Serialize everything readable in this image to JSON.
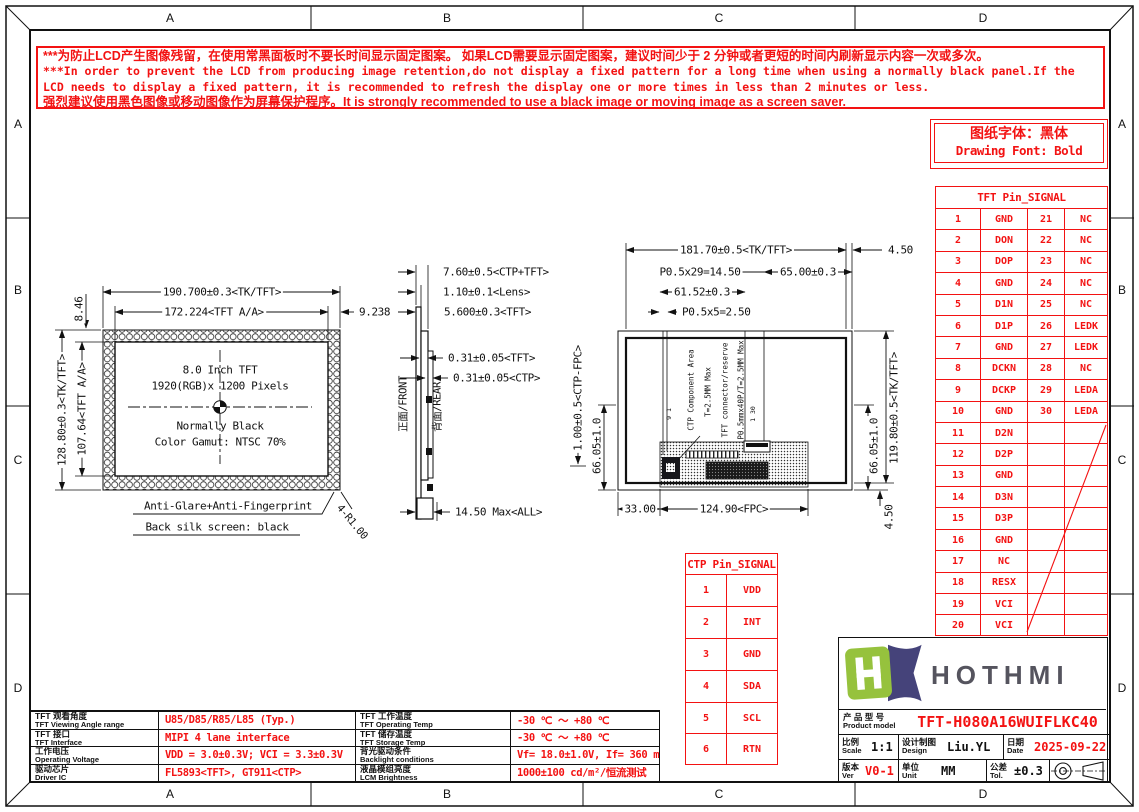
{
  "colors": {
    "red": "#f31212",
    "line_black": "#111111",
    "logo_green": "#96c23d",
    "logo_navy": "#45437a",
    "brand_gray": "#55545e"
  },
  "frame": {
    "zones": [
      "A",
      "B",
      "C",
      "D"
    ]
  },
  "warning": {
    "lines": [
      "***为防止LCD产生图像残留，在使用常黑面板时不要长时间显示固定图案。 如果LCD需要显示固定图案，建议时间少于 2 分钟或者更短的时间内刷新显示内容一次或多次。",
      "***In order to prevent the LCD from producing image retention,do not display a fixed pattern for a long time when using a normally black panel.If the",
      " LCD needs to display a fixed pattern, it is recommended to refresh the display one or more times in less than 2 minutes or less.",
      "强烈建议使用黑色图像或移动图像作为屏幕保护程序。It is strongly recommended to use a black image or moving image as a screen saver."
    ]
  },
  "font_note": {
    "cn": "图纸字体：黑体",
    "en": "Drawing Font: Bold"
  },
  "tft_pin_table": {
    "title": "TFT Pin_SIGNAL",
    "rows": [
      [
        "1",
        "GND",
        "21",
        "NC"
      ],
      [
        "2",
        "DON",
        "22",
        "NC"
      ],
      [
        "3",
        "DOP",
        "23",
        "NC"
      ],
      [
        "4",
        "GND",
        "24",
        "NC"
      ],
      [
        "5",
        "D1N",
        "25",
        "NC"
      ],
      [
        "6",
        "D1P",
        "26",
        "LEDK"
      ],
      [
        "7",
        "GND",
        "27",
        "LEDK"
      ],
      [
        "8",
        "DCKN",
        "28",
        "NC"
      ],
      [
        "9",
        "DCKP",
        "29",
        "LEDA"
      ],
      [
        "10",
        "GND",
        "30",
        "LEDA"
      ],
      [
        "11",
        "D2N",
        "",
        ""
      ],
      [
        "12",
        "D2P",
        "",
        ""
      ],
      [
        "13",
        "GND",
        "",
        ""
      ],
      [
        "14",
        "D3N",
        "",
        ""
      ],
      [
        "15",
        "D3P",
        "",
        ""
      ],
      [
        "16",
        "GND",
        "",
        ""
      ],
      [
        "17",
        "NC",
        "",
        ""
      ],
      [
        "18",
        "RESX",
        "",
        ""
      ],
      [
        "19",
        "VCI",
        "",
        ""
      ],
      [
        "20",
        "VCI",
        "",
        ""
      ]
    ]
  },
  "ctp_pin_table": {
    "title": "CTP Pin_SIGNAL",
    "rows": [
      [
        "1",
        "VDD"
      ],
      [
        "2",
        "INT"
      ],
      [
        "3",
        "GND"
      ],
      [
        "4",
        "SDA"
      ],
      [
        "5",
        "SCL"
      ],
      [
        "6",
        "RTN"
      ]
    ]
  },
  "front_view": {
    "dim_width_outer": "190.700±0.3<TK/TFT>",
    "dim_width_aa": "172.224<TFT A/A>",
    "dim_border_right": "9.238",
    "dim_border_top": "8.46",
    "dim_height_outer": "128.80±0.3<TK/TFT>",
    "dim_height_aa": "107.64<TFT A/A>",
    "center_text": [
      "8.0 Inch TFT",
      "1920(RGB)x 1200 Pixels",
      "Normally Black",
      "Color Gamut: NTSC 70%"
    ],
    "note1": "Anti-Glare+Anti-Fingerprint",
    "note2": "Back silk screen: black",
    "corner_radius": "4-R1.00"
  },
  "side_view": {
    "dims": [
      "7.60±0.5<CTP+TFT>",
      "1.10±0.1<Lens>",
      "5.600±0.3<TFT>",
      "0.31±0.05<TFT>",
      "0.31±0.05<CTP>"
    ],
    "dim_total": "14.50 Max<ALL>",
    "front_label": "正面/FRONT",
    "rear_label": "背面/REAR"
  },
  "back_view": {
    "dim_width_outer": "181.70±0.5<TK/TFT>",
    "dim_edge_top_right": "4.50",
    "dim_pins_tft": "P0.5x29=14.50",
    "dim_conn_offset": "65.00±0.3",
    "dim_ctp_offset": "61.52±0.3",
    "dim_pins_ctp": "P0.5x5=2.50",
    "dim_ctp_fpc": "1.00±0.5<CTP-FPC>",
    "dim_conn_left_y": "66.05±1.0",
    "dim_conn_right_y": "66.05±1.0",
    "dim_height_outer": "119.80±0.5<TK/TFT>",
    "dim_edge_bottom_right": "4.50",
    "dim_fpc_left": "33.00",
    "dim_fpc_width": "124.90<FPC>",
    "ann_ctp_area": "CTP Component Area",
    "ann_ctp_thick": "T=2.5MM Max",
    "ann_tft_conn": "TFT connector/reserve",
    "ann_tft_pins": "P0.5mmx40P/T=2.5MM Max",
    "pin_mark_ctp": "9 1",
    "pin_mark_tft": "1 30"
  },
  "spec_table": {
    "left": [
      {
        "cn": "TFT 观看角度",
        "en": "TFT Viewing Angle range",
        "value": "U85/D85/R85/L85 (Typ.)"
      },
      {
        "cn": "TFT 接口",
        "en": "TFT Interface",
        "value": "MIPI 4 lane interface"
      },
      {
        "cn": "工作电压",
        "en": "Operating Voltage",
        "value": "VDD = 3.0±0.3V; VCI = 3.3±0.3V"
      },
      {
        "cn": "驱动芯片",
        "en": "Driver IC",
        "value": "FL5893<TFT>, GT911<CTP>"
      }
    ],
    "right": [
      {
        "cn": "TFT 工作温度",
        "en": "TFT Operating Temp",
        "value": "-30 ℃ ～ +80 ℃"
      },
      {
        "cn": "TFT 储存温度",
        "en": "TFT Storage Temp",
        "value": "-30 ℃ ～ +80 ℃"
      },
      {
        "cn": "背光驱动条件",
        "en": "Backlight conditions",
        "value": "Vf= 18.0±1.0V, If= 360 mA"
      },
      {
        "cn": "液晶模组亮度",
        "en": "LCM Brightness",
        "value": "1000±100 cd/m²/恒流测试"
      }
    ]
  },
  "title_block": {
    "brand": "HOTHMI",
    "product_label_cn": "产 品 型 号",
    "product_label_en": "Product model",
    "product_model": "TFT-H080A16WUIFLKC40",
    "scale_cn": "比例",
    "scale_en": "Scale",
    "scale_value": "1:1",
    "design_cn": "设计制图",
    "design_en": "Design",
    "design_value": "Liu.YL",
    "date_cn": "日期",
    "date_en": "Date",
    "date_value": "2025-09-22",
    "ver_cn": "版本",
    "ver_en": "Ver",
    "ver_value": "V0-1",
    "unit_cn": "单位",
    "unit_en": "Unit",
    "unit_value": "MM",
    "tol_cn": "公差",
    "tol_en": "Tol.",
    "tol_value": "±0.3"
  }
}
